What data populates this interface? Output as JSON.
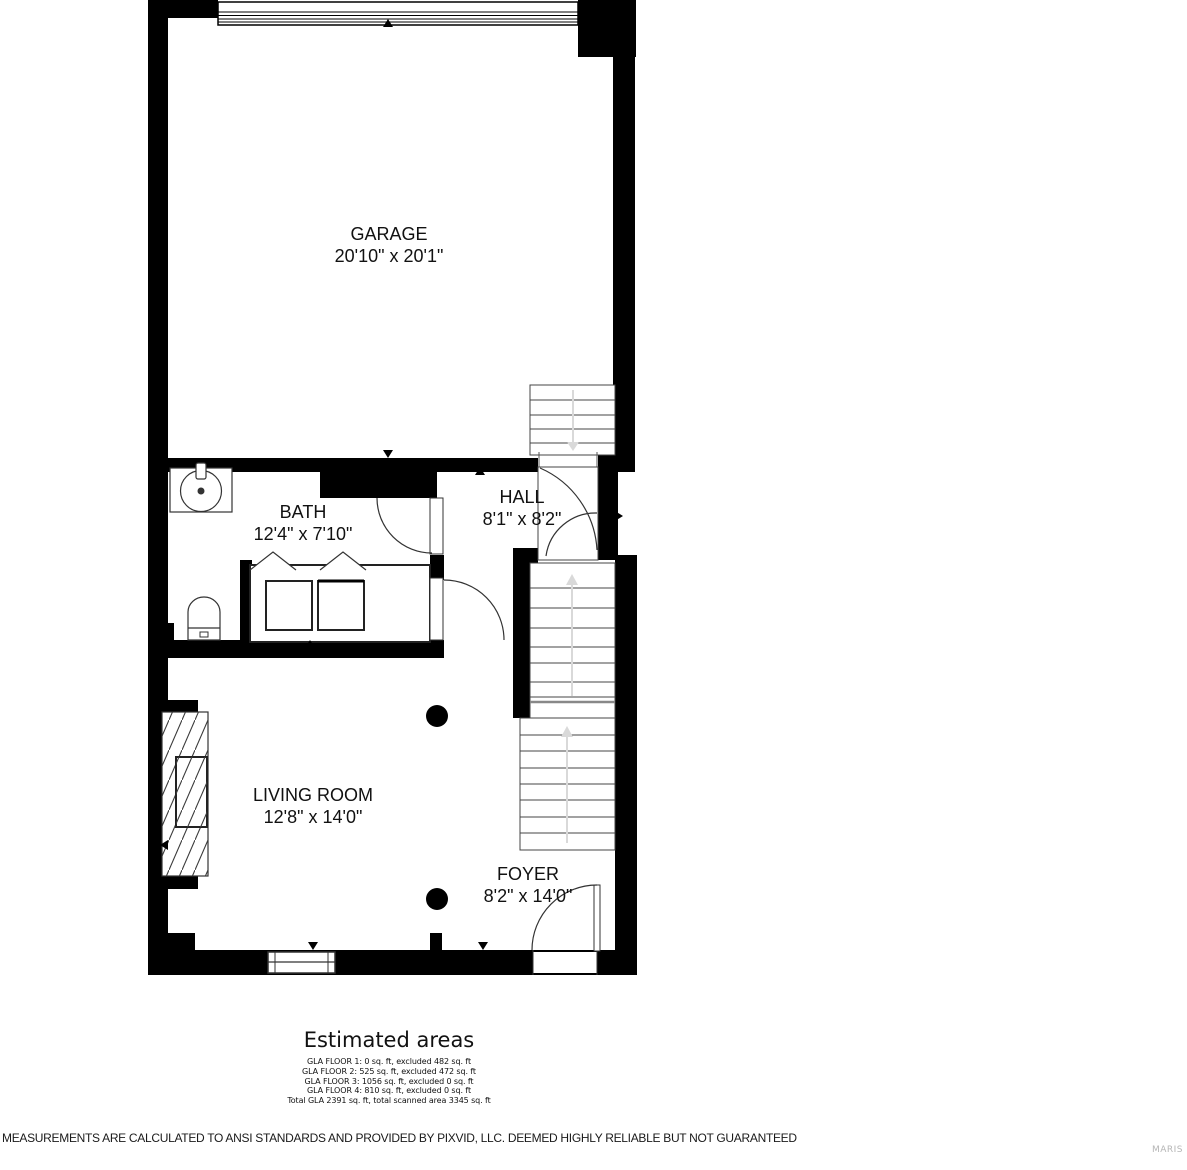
{
  "plan": {
    "rooms": [
      {
        "name": "GARAGE",
        "dims": "20'10\" x 20'1\""
      },
      {
        "name": "BATH",
        "dims": "12'4\" x 7'10\""
      },
      {
        "name": "HALL",
        "dims": "8'1\" x 8'2\""
      },
      {
        "name": "LIVING ROOM",
        "dims": "12'8\" x 14'0\""
      },
      {
        "name": "FOYER",
        "dims": "8'2\" x 14'0\""
      }
    ]
  },
  "estimated_areas": {
    "title": "Estimated areas",
    "lines": [
      "GLA FLOOR 1: 0 sq. ft, excluded 482 sq. ft",
      "GLA FLOOR 2: 525 sq. ft, excluded 472 sq. ft",
      "GLA FLOOR 3: 1056 sq. ft, excluded 0 sq. ft",
      "GLA FLOOR 4: 810 sq. ft, excluded 0 sq. ft",
      "Total GLA 2391 sq. ft, total scanned area 3345 sq. ft"
    ]
  },
  "disclaimer": "MEASUREMENTS ARE CALCULATED TO ANSI STANDARDS AND PROVIDED BY PIXVID, LLC. DEEMED HIGHLY RELIABLE BUT NOT GUARANTEED",
  "watermark": "MARIS",
  "colors": {
    "wall": "#000000",
    "line": "#3a3a3a",
    "stair_arrow": "#d9d9d9"
  }
}
